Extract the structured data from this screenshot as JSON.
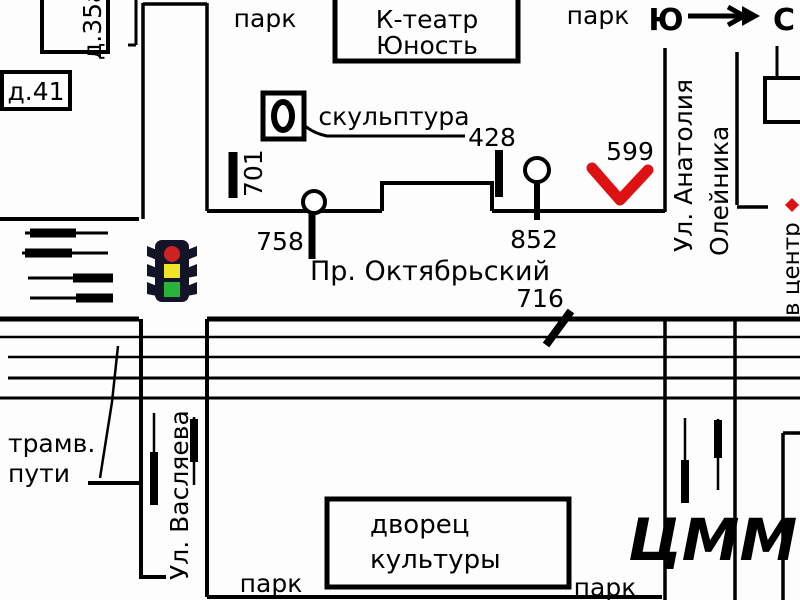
{
  "compass": {
    "south_label": "Ю",
    "north_label": "С"
  },
  "parks": {
    "top_left": "парк",
    "top_right": "парк",
    "bottom_left": "парк",
    "bottom_right": "парк"
  },
  "buildings": {
    "house_35a": "д.35а",
    "house_41": "д.41",
    "theater_line1": "К-театр",
    "theater_line2": "Юность",
    "palace_line1": "дворец",
    "palace_line2": "культуры"
  },
  "streets": {
    "oktyabrsky": "Пр. Октябрьский",
    "vaslyaeva": "Ул. Васляева",
    "oleinika_line1": "Ул. Анатолия",
    "oleinika_line2": "Олейника",
    "to_center": "в центр",
    "tram_caption_line1": "трамв.",
    "tram_caption_line2": "пути"
  },
  "poi": {
    "sculpture": "скульптура"
  },
  "numbers": {
    "n701": "701",
    "n428": "428",
    "n599": "599",
    "n758": "758",
    "n852": "852",
    "n716": "716"
  },
  "watermark": "ЦММ",
  "colors": {
    "ink": "#000000",
    "marker_red": "#dd1111",
    "watermark_blue": "#c9c9ea",
    "traffic_body": "#141428",
    "traffic_red": "#cc2222",
    "traffic_yellow": "#efe32a",
    "traffic_green": "#2ab33a",
    "background": "#ffffff"
  }
}
